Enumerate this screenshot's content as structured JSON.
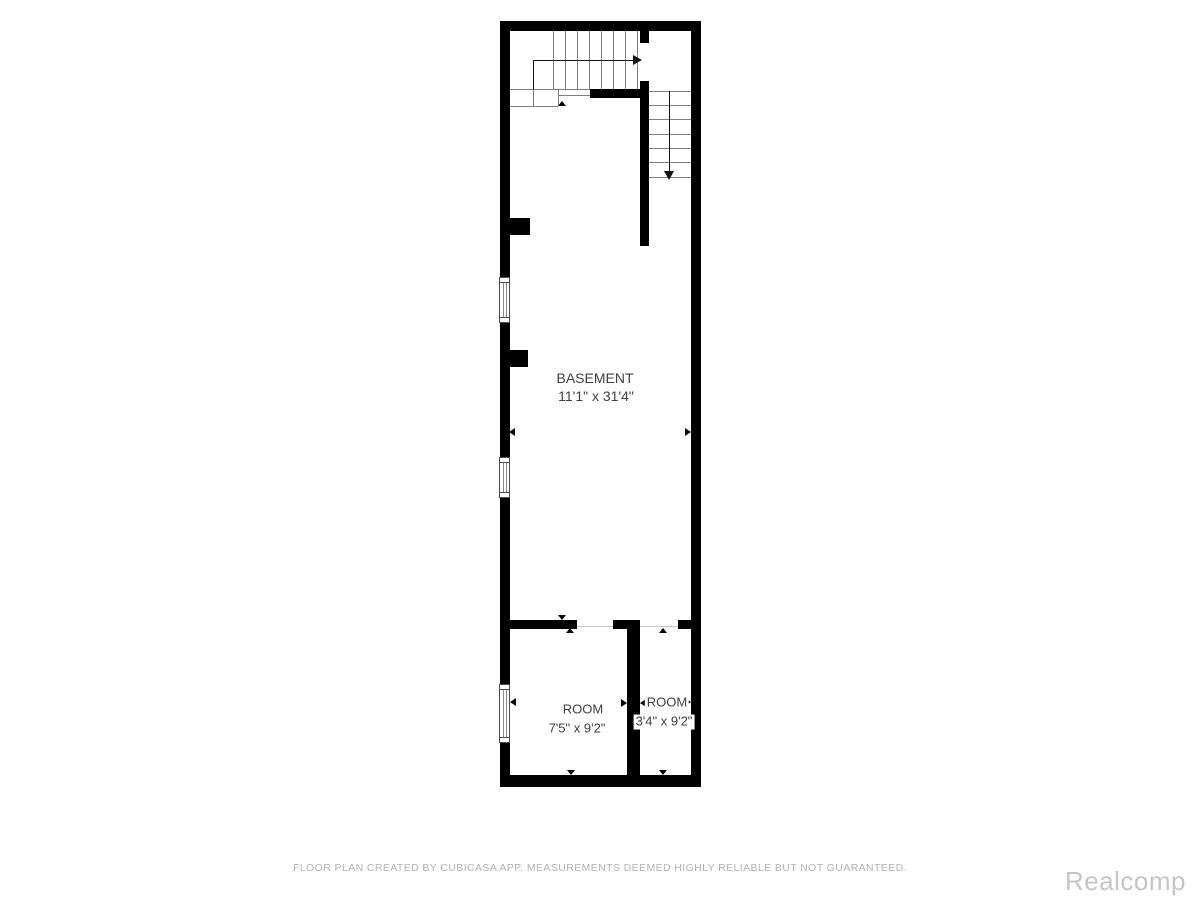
{
  "colors": {
    "wall": "#000000",
    "line": "#7e7e7e",
    "faint": "#c9c9c9",
    "winb": "#4d4d4d",
    "label": "#3f3f3f",
    "footer": "#b3b3b3",
    "mark": "#c5c5c5",
    "bg": "#ffffff"
  },
  "rooms": {
    "basement": {
      "name": "BASEMENT",
      "dims": "11'1\" x 31'4\""
    },
    "room_left": {
      "name": "ROOM",
      "dims": "7'5\" x 9'2\""
    },
    "room_right": {
      "name": "ROOM",
      "dims": "3'4\" x 9'2\""
    }
  },
  "icons": {
    "stair_up_arrow": "arrow-right-icon",
    "stair_down_arrow": "arrow-down-icon",
    "opening_markers": "small-triangle-icons"
  },
  "footer": {
    "disclaimer": "FLOOR PLAN CREATED BY CUBICASA APP. MEASUREMENTS DEEMED HIGHLY RELIABLE BUT NOT GUARANTEED."
  },
  "watermark": {
    "text": "Realcomp"
  }
}
